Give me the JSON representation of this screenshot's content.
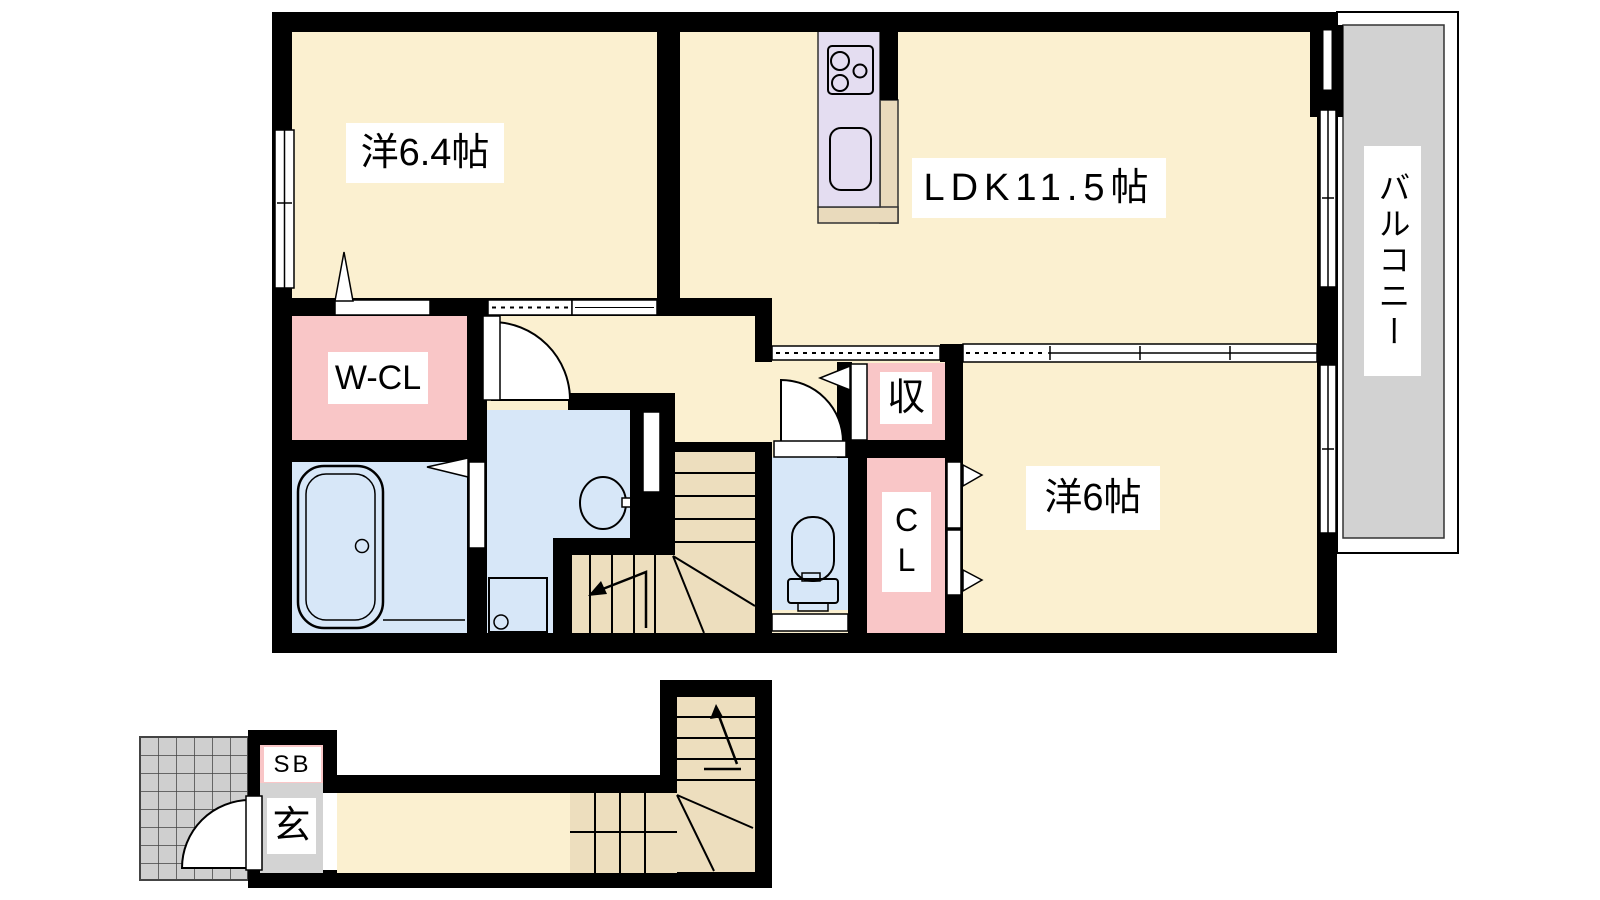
{
  "title": "2LDK apartment floor plan",
  "palette": {
    "wall": "#000000",
    "floor_cream": "#FBF0D0",
    "stair_tan": "#EDDEBE",
    "closet_pink": "#F9C6C7",
    "wet_area_blue": "#D7E7F8",
    "kitchen_lavender": "#E4DDF1",
    "kitchen_counter_tan": "#E9DABC",
    "balcony_gray": "#D2D2D2",
    "tile_gray": "#CFCFCF",
    "entrance_gray": "#D3D3D3"
  },
  "labels": {
    "western_room_64": "洋6.4帖",
    "ldk": "LDK11.5帖",
    "western_room_6": "洋6帖",
    "walk_in_closet": "W-CL",
    "storage": "収",
    "closet": "CL",
    "balcony": "バルコニー",
    "shoe_box": "SB",
    "entrance": "玄"
  }
}
